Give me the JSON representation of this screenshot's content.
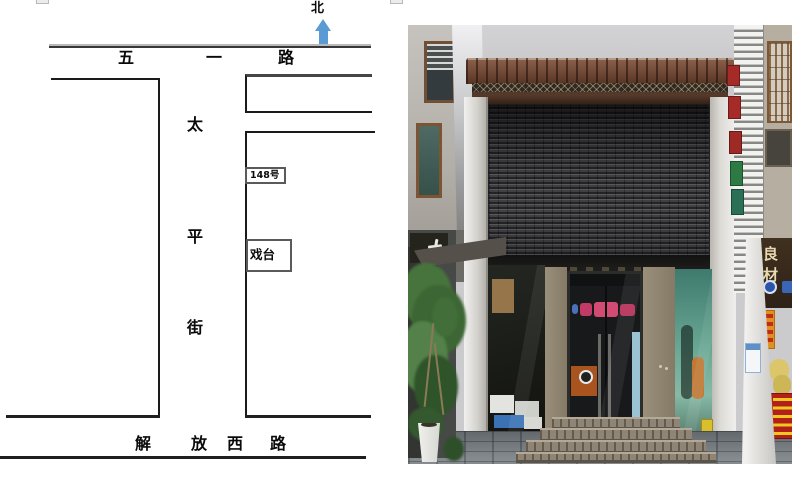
{
  "map": {
    "compass": {
      "label": "北"
    },
    "top_road": {
      "name": "五一路",
      "chars": [
        "五",
        "一",
        "路"
      ]
    },
    "vertical_street": {
      "name": "太平街",
      "chars": [
        "太",
        "平",
        "街"
      ]
    },
    "address_box": {
      "label": "148号"
    },
    "stage_box": {
      "label": "戏台"
    },
    "bottom_road": {
      "name": "解放西路",
      "chars": [
        "解",
        "放",
        "西",
        "路"
      ]
    },
    "colors": {
      "north_arrow": "#5b9bd5",
      "outline": "#1a1a1a"
    }
  },
  "photo": {
    "right_shop_sign": {
      "label": "良材"
    },
    "colors": {
      "shutter": "#47464b",
      "roof_tile": "#78462f",
      "storefront_pillar": "#8d8371",
      "teal_window": "#6aa894",
      "menu_sign_red": "#b22019",
      "menu_text_yellow": "#efc922"
    }
  }
}
